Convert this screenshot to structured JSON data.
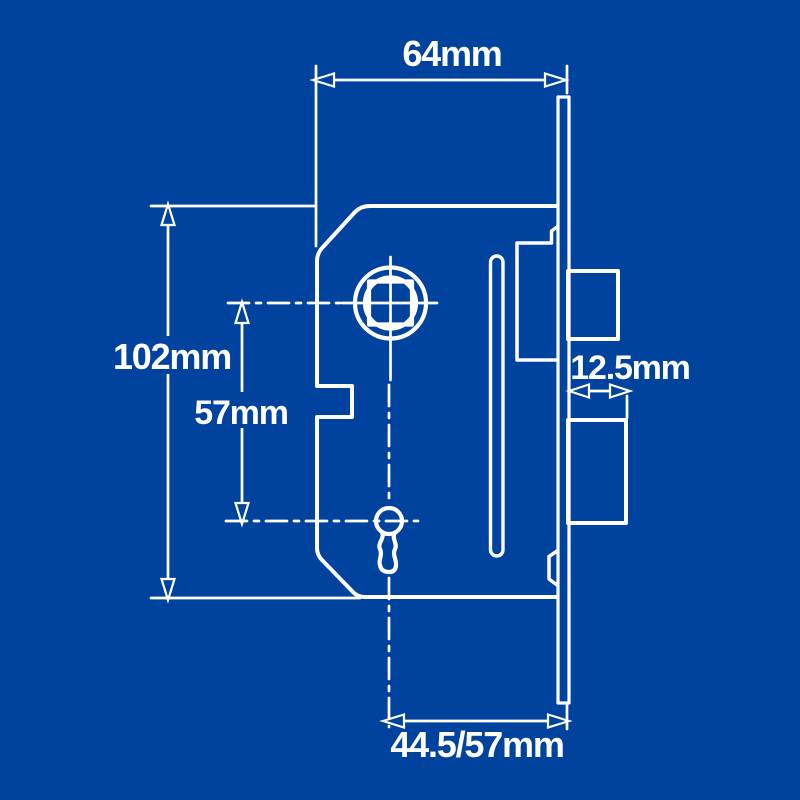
{
  "colors": {
    "background": "#00439E",
    "line": "#FFFFFF"
  },
  "dimensions": {
    "case_width": "64mm",
    "case_height": "102mm",
    "spindle_to_keyhole": "57mm",
    "bolt_throw": "12.5mm",
    "backset": "44.5/57mm"
  }
}
